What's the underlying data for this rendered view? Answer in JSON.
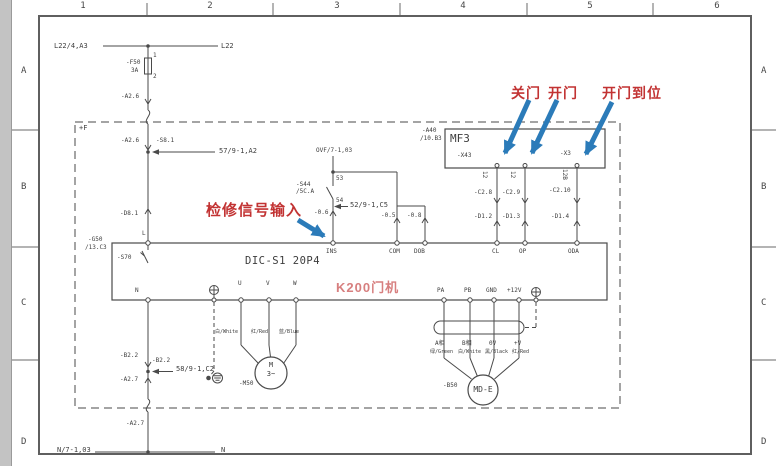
{
  "colors": {
    "line": "#4a4a4a",
    "red": "#c23333",
    "pink": "#d77f7f",
    "blue": "#2b7bb9",
    "text": "#3d3d3d"
  },
  "ruler": {
    "columns": [
      "1",
      "2",
      "3",
      "4",
      "5",
      "6"
    ],
    "rows": [
      "A",
      "B",
      "C",
      "D"
    ]
  },
  "annotations": {
    "inspection_input": "检修信号输入",
    "door_close": "关门",
    "door_open": "开门",
    "door_open_in_place": "开门到位"
  },
  "devices": {
    "controller_model": "DIC-S1 20P4",
    "machine_name": "K200门机",
    "interface_board": "MF3",
    "zone": "+F",
    "motor_symbol": "M",
    "motor_phases": "3~",
    "encoder_model": "MD-E"
  },
  "labels": [
    {
      "n": "wire-l22-source",
      "t": "L22/4,A3",
      "x": 54,
      "y": 42,
      "c": "m7"
    },
    {
      "n": "wire-l22",
      "t": "L22",
      "x": 221,
      "y": 42,
      "c": "m7"
    },
    {
      "n": "fuse-ref",
      "t": "-F50",
      "x": 126,
      "y": 60
    },
    {
      "n": "fuse-rating",
      "t": "3A",
      "x": 131,
      "y": 68
    },
    {
      "n": "fuse-pin-1",
      "t": "1",
      "x": 153,
      "y": 53
    },
    {
      "n": "fuse-pin-2",
      "t": "2",
      "x": 153,
      "y": 74
    },
    {
      "n": "wire-a26-top",
      "t": "-A2.6",
      "x": 121,
      "y": 94
    },
    {
      "n": "wire-a26",
      "t": "-A2.6",
      "x": 121,
      "y": 138
    },
    {
      "n": "connector-s81",
      "t": "-S8.1",
      "x": 156,
      "y": 138
    },
    {
      "n": "ref-sheet-57",
      "t": "57/9-1,A2",
      "x": 219,
      "y": 147,
      "c": "m7"
    },
    {
      "n": "connector-d81",
      "t": "-D8.1",
      "x": 120,
      "y": 211
    },
    {
      "n": "ref-g50",
      "t": "-G50",
      "x": 88,
      "y": 237
    },
    {
      "n": "ref-g50-loc",
      "t": "/13.C3",
      "x": 85,
      "y": 245
    },
    {
      "n": "terminal-l",
      "t": "L",
      "x": 142,
      "y": 231
    },
    {
      "n": "switch-s70",
      "t": "-S70",
      "x": 117,
      "y": 255
    },
    {
      "n": "wire-b22-a",
      "t": "-B2.2",
      "x": 120,
      "y": 353
    },
    {
      "n": "wire-b22-b",
      "t": "-B2.2",
      "x": 152,
      "y": 358
    },
    {
      "n": "ref-sheet-58",
      "t": "58/9-1,C2",
      "x": 176,
      "y": 365,
      "c": "m7"
    },
    {
      "n": "wire-a27-a",
      "t": "-A2.7",
      "x": 120,
      "y": 377
    },
    {
      "n": "wire-a27-b",
      "t": "-A2.7",
      "x": 126,
      "y": 421
    },
    {
      "n": "wire-n-source",
      "t": "N/7-1,03",
      "x": 57,
      "y": 446,
      "c": "m7"
    },
    {
      "n": "wire-n-end",
      "t": "N",
      "x": 221,
      "y": 446,
      "c": "m7"
    },
    {
      "n": "terminal-n",
      "t": "N",
      "x": 135,
      "y": 288
    },
    {
      "n": "ref-ovf",
      "t": "OVF/7-1,03",
      "x": 316,
      "y": 148
    },
    {
      "n": "contact-pin-53",
      "t": "53",
      "x": 336,
      "y": 176
    },
    {
      "n": "contact-pin-54",
      "t": "54",
      "x": 336,
      "y": 198
    },
    {
      "n": "switch-s44",
      "t": "-S44",
      "x": 296,
      "y": 182
    },
    {
      "n": "switch-s44-loc",
      "t": "/5C.A",
      "x": 296,
      "y": 189
    },
    {
      "n": "ref-sheet-52",
      "t": "52/9-1,C5",
      "x": 350,
      "y": 201,
      "c": "m7"
    },
    {
      "n": "wire-06",
      "t": "-0.6",
      "x": 314,
      "y": 210
    },
    {
      "n": "wire-05",
      "t": "-0.5",
      "x": 381,
      "y": 213
    },
    {
      "n": "wire-08",
      "t": "-0.8",
      "x": 407,
      "y": 213
    },
    {
      "n": "terminal-ins",
      "t": "INS",
      "x": 326,
      "y": 249
    },
    {
      "n": "terminal-com",
      "t": "COM",
      "x": 389,
      "y": 249
    },
    {
      "n": "terminal-dob",
      "t": "DOB",
      "x": 414,
      "y": 249
    },
    {
      "n": "ref-a40",
      "t": "-A40",
      "x": 422,
      "y": 128
    },
    {
      "n": "ref-a40-loc",
      "t": "/10.B3",
      "x": 420,
      "y": 136
    },
    {
      "n": "terminal-x43",
      "t": "-X43",
      "x": 457,
      "y": 153
    },
    {
      "n": "terminal-x3",
      "t": "-X3",
      "x": 560,
      "y": 151
    },
    {
      "n": "pin-12-a",
      "t": "12",
      "x": 487,
      "y": 171,
      "c": "rot"
    },
    {
      "n": "pin-12-b",
      "t": "12",
      "x": 515,
      "y": 171,
      "c": "rot"
    },
    {
      "n": "pin-12b-c",
      "t": "12B",
      "x": 567,
      "y": 169,
      "c": "rot"
    },
    {
      "n": "wire-c28",
      "t": "-C2.8",
      "x": 474,
      "y": 190
    },
    {
      "n": "wire-c29",
      "t": "-C2.9",
      "x": 502,
      "y": 190
    },
    {
      "n": "wire-c210",
      "t": "-C2.10",
      "x": 549,
      "y": 188
    },
    {
      "n": "wire-d12",
      "t": "-D1.2",
      "x": 474,
      "y": 214
    },
    {
      "n": "wire-d13",
      "t": "-D1.3",
      "x": 502,
      "y": 214
    },
    {
      "n": "wire-d14",
      "t": "-D1.4",
      "x": 551,
      "y": 214
    },
    {
      "n": "terminal-cl",
      "t": "CL",
      "x": 492,
      "y": 249
    },
    {
      "n": "terminal-op",
      "t": "OP",
      "x": 519,
      "y": 249
    },
    {
      "n": "terminal-oda",
      "t": "ODA",
      "x": 568,
      "y": 249
    },
    {
      "n": "terminal-pa",
      "t": "PA",
      "x": 437,
      "y": 288
    },
    {
      "n": "terminal-pb",
      "t": "PB",
      "x": 464,
      "y": 288
    },
    {
      "n": "terminal-gnd",
      "t": "GND",
      "x": 486,
      "y": 288
    },
    {
      "n": "terminal-12v",
      "t": "+12V",
      "x": 507,
      "y": 288
    },
    {
      "n": "terminal-u",
      "t": "U",
      "x": 238,
      "y": 281
    },
    {
      "n": "terminal-v",
      "t": "V",
      "x": 266,
      "y": 281
    },
    {
      "n": "terminal-w",
      "t": "W",
      "x": 293,
      "y": 281
    },
    {
      "n": "wire-u-color",
      "t": "白/White",
      "x": 215,
      "y": 330,
      "c": "s5"
    },
    {
      "n": "wire-v-color",
      "t": "红/Red",
      "x": 251,
      "y": 330,
      "c": "s5"
    },
    {
      "n": "wire-w-color",
      "t": "蓝/Blue",
      "x": 279,
      "y": 330,
      "c": "s5"
    },
    {
      "n": "motor-ref",
      "t": "-M50",
      "x": 239,
      "y": 381
    },
    {
      "n": "encoder-a-phase",
      "t": "A相",
      "x": 435,
      "y": 341
    },
    {
      "n": "encoder-b-phase",
      "t": "B相",
      "x": 462,
      "y": 341
    },
    {
      "n": "encoder-0v",
      "t": "0V",
      "x": 489,
      "y": 341
    },
    {
      "n": "encoder-plusv",
      "t": "+V",
      "x": 514,
      "y": 341
    },
    {
      "n": "encoder-a-color",
      "t": "绿/Green",
      "x": 430,
      "y": 350,
      "c": "s5"
    },
    {
      "n": "encoder-b-color",
      "t": "白/White",
      "x": 458,
      "y": 350,
      "c": "s5"
    },
    {
      "n": "encoder-0-color",
      "t": "黑/Black",
      "x": 485,
      "y": 350,
      "c": "s5"
    },
    {
      "n": "encoder-v-color",
      "t": "红/Red",
      "x": 512,
      "y": 350,
      "c": "s5"
    },
    {
      "n": "encoder-ref",
      "t": "-B50",
      "x": 443,
      "y": 383
    }
  ]
}
